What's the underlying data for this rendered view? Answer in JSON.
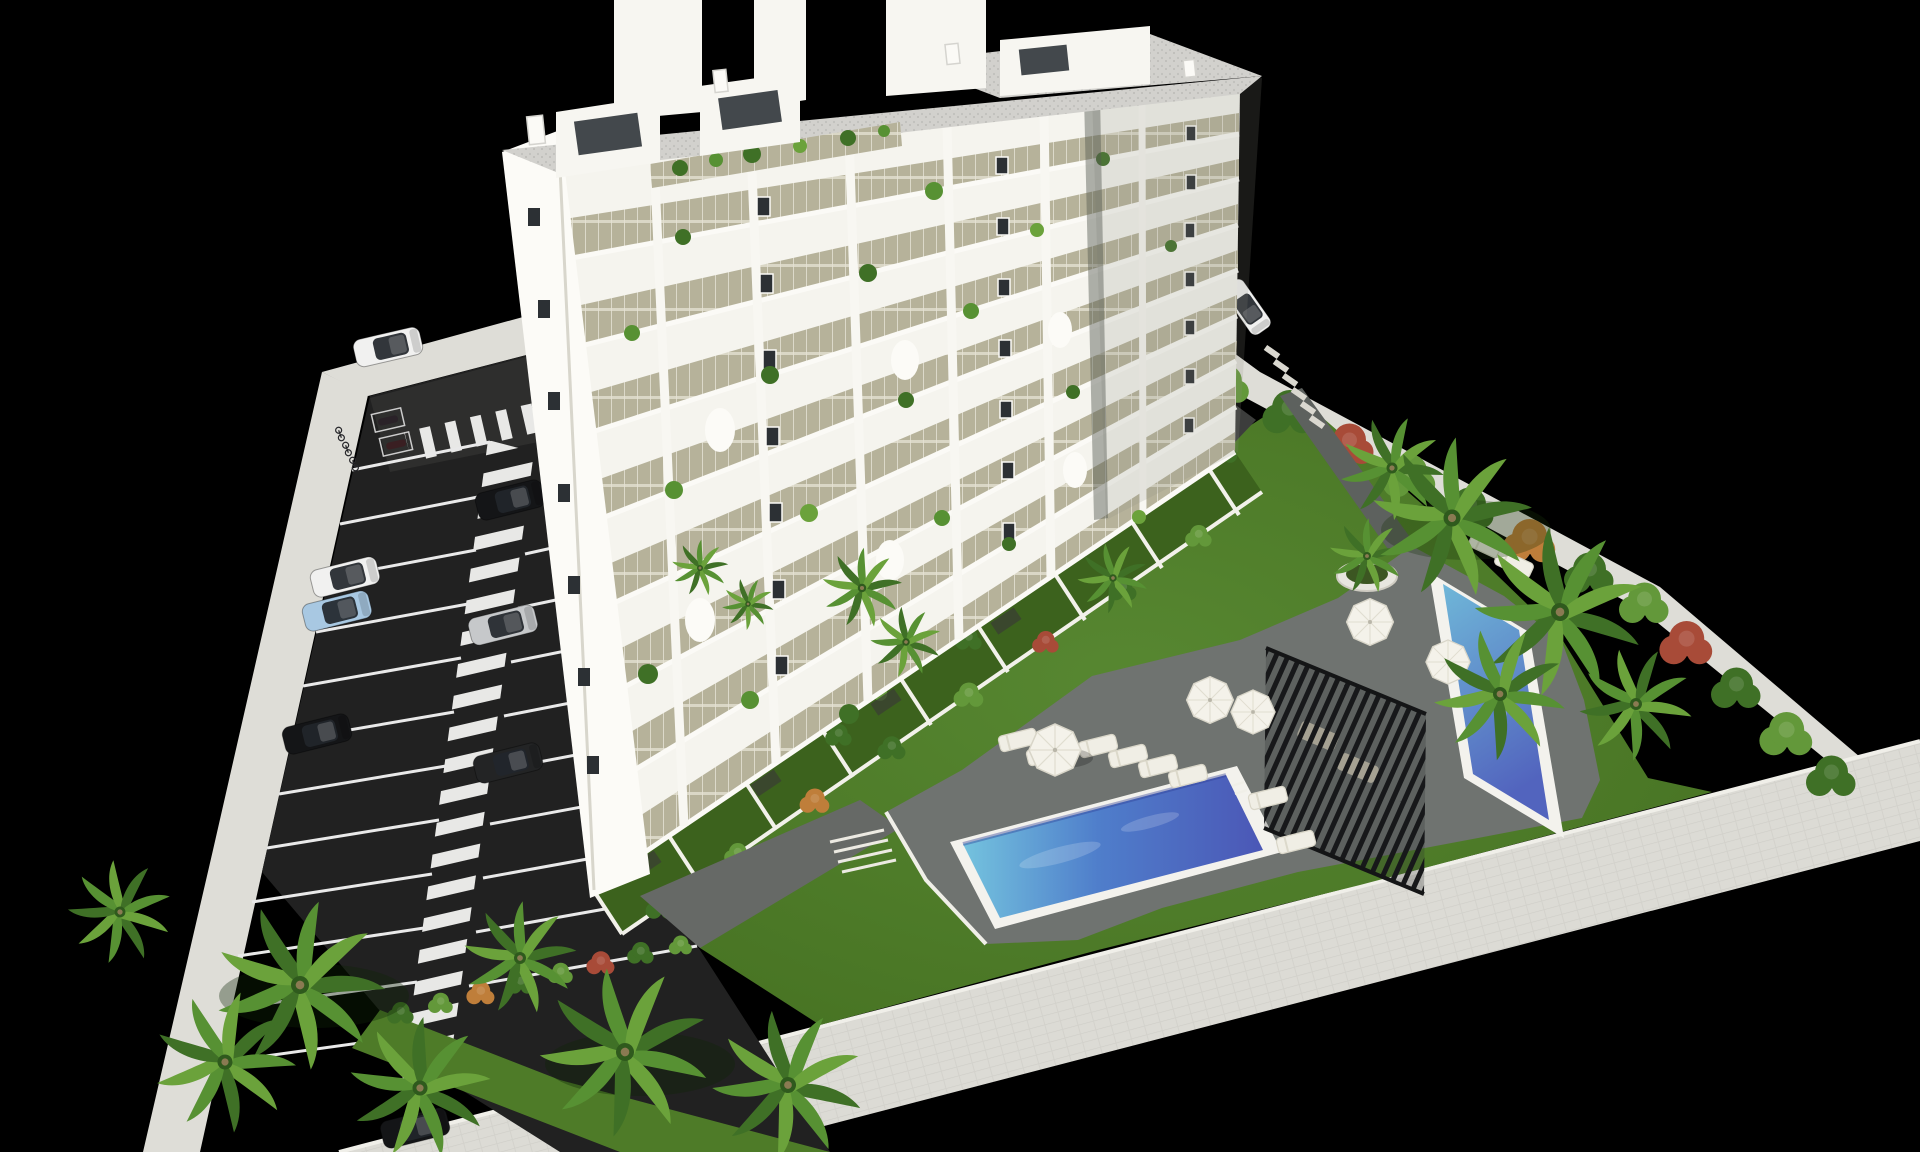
{
  "scene": {
    "type": "architectural-aerial-render",
    "description": "Aerial 3D rendering of a white residential apartment block on a walled plot with parking lot, landscaped garden, two swimming pools, pergola and palm trees, on a black background",
    "colors": {
      "background": "#000000",
      "wall": "#deddd7",
      "wall_dark": "#c8c7c1",
      "asphalt": "#212121",
      "asphalt_light": "#2e2e2d",
      "marking": "#e9e9e9",
      "lawn": "#4e7b28",
      "lawn_dark": "#3c621d",
      "lawn_deep": "#2f5116",
      "deck": "#6f7370",
      "path": "#5d615e",
      "pool_rim": "#f3f2ed",
      "water_deep": "#4b57b6",
      "water_mid": "#4f7ecb",
      "water_light": "#74c3de",
      "water_kids_deep": "#5264be",
      "building": "#f5f4ee",
      "building_bright": "#fcfbf7",
      "building_shade": "#e7e6df",
      "glass": "#b6b29a",
      "window": "#2c3034",
      "roof": "#d2d1cd",
      "pergola": "#1a1b1c",
      "umbrella": "#f4f2ea",
      "lounger": "#f0eee5",
      "plant": "#3f7026",
      "plant_light": "#63983a",
      "plant_deep": "#2f5a1d",
      "accent_orange": "#bf7e3a",
      "accent_red": "#a84b38",
      "trunk": "#8a7a52"
    },
    "building": {
      "balcony_floors": 8,
      "balcony_bays": 7,
      "penthouse_volumes": 3,
      "chimneys": 4,
      "facade_plants": 18
    },
    "parking": {
      "stall_rows": 2,
      "marked_stalls": 22,
      "zebra_walkway": true,
      "bike_rack_bikes": 3,
      "moto_stalls": 2,
      "cars": [
        {
          "label": "white car driving at entrance",
          "color": "#f1f1f0"
        },
        {
          "label": "black car right row",
          "color": "#141517"
        },
        {
          "label": "white car left row",
          "color": "#f1f1f0"
        },
        {
          "label": "light blue car left row",
          "color": "#a8c8e2"
        },
        {
          "label": "silver car right row",
          "color": "#c6c8ca"
        },
        {
          "label": "black car left row",
          "color": "#141517"
        },
        {
          "label": "dark gray car right row",
          "color": "#232425"
        },
        {
          "label": "black car bottom under palms",
          "color": "#141517"
        },
        {
          "label": "white car on rear driveway",
          "color": "#f1f1f0"
        }
      ]
    },
    "pools": {
      "main_pool": {
        "shape": "long rectangle",
        "rim": "white"
      },
      "kids_pool": {
        "shape": "small rectangle",
        "rim": "white"
      }
    },
    "amenities": {
      "umbrellas": 5,
      "sun_loungers": 12,
      "pergola": 1,
      "round_planter": 1,
      "garden_stairs": 1
    },
    "vegetation": {
      "palm_clusters": 3,
      "hedge_shrubs": "green with orange and red flowering accents",
      "terraced_private_gardens": 8
    }
  }
}
